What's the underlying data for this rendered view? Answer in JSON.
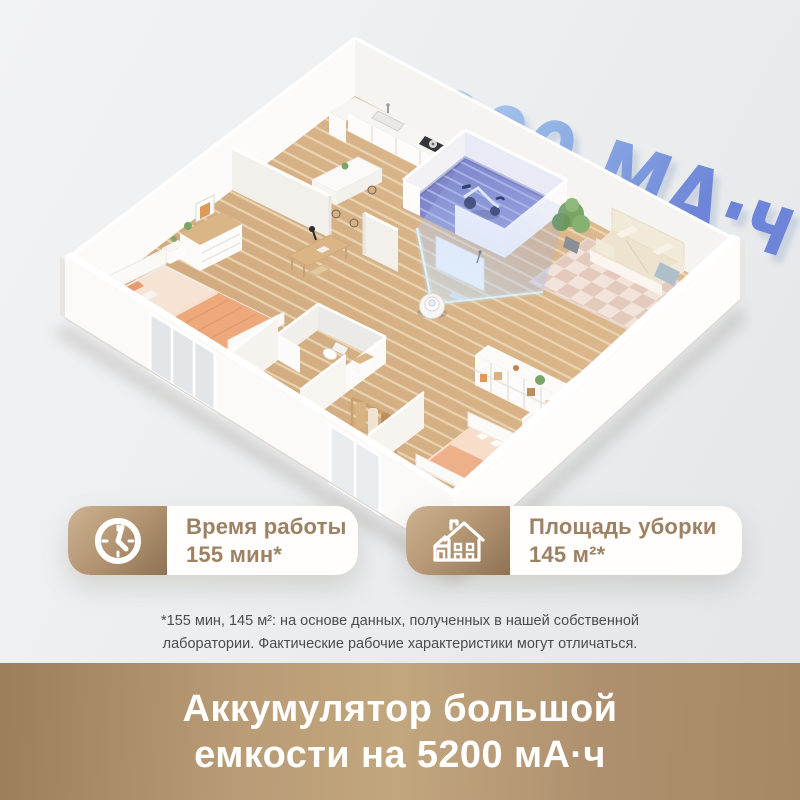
{
  "page": {
    "background": "#edeff1"
  },
  "headline": {
    "text": "5200 МА·ч",
    "gradient_from": "#c7dff3",
    "gradient_mid": "#92b4e6",
    "gradient_to": "#6d85d8"
  },
  "stats": [
    {
      "icon": "clock-icon",
      "label": "Время работы",
      "value": "155 мин*",
      "accent_from": "#cbb392",
      "accent_to": "#8f7254",
      "text_color": "#9c8164"
    },
    {
      "icon": "house-icon",
      "label": "Площадь уборки",
      "value": "145 м²*",
      "accent_from": "#cbb392",
      "accent_to": "#8f7254",
      "text_color": "#9c8164"
    }
  ],
  "disclaimer": {
    "line1": "*155 мин, 145 м²: на основе данных, полученных в нашей собственной",
    "line2": "лаборатории. Фактические рабочие характеристики могут отличаться."
  },
  "banner": {
    "line1": "Аккумулятор большой",
    "line2": "емкости на 5200 мА·ч",
    "background_from": "#9c7e58",
    "background_mid": "#c2a67e",
    "background_to": "#a68862",
    "text_color": "#ffffff"
  },
  "illustration_colors": {
    "wood_floor": "#d9b58a",
    "clean_path_line": "#eedcbc",
    "gym_floor": "#8289cb",
    "beam": "#bfe3ff",
    "walls": "#fbfaf8"
  }
}
